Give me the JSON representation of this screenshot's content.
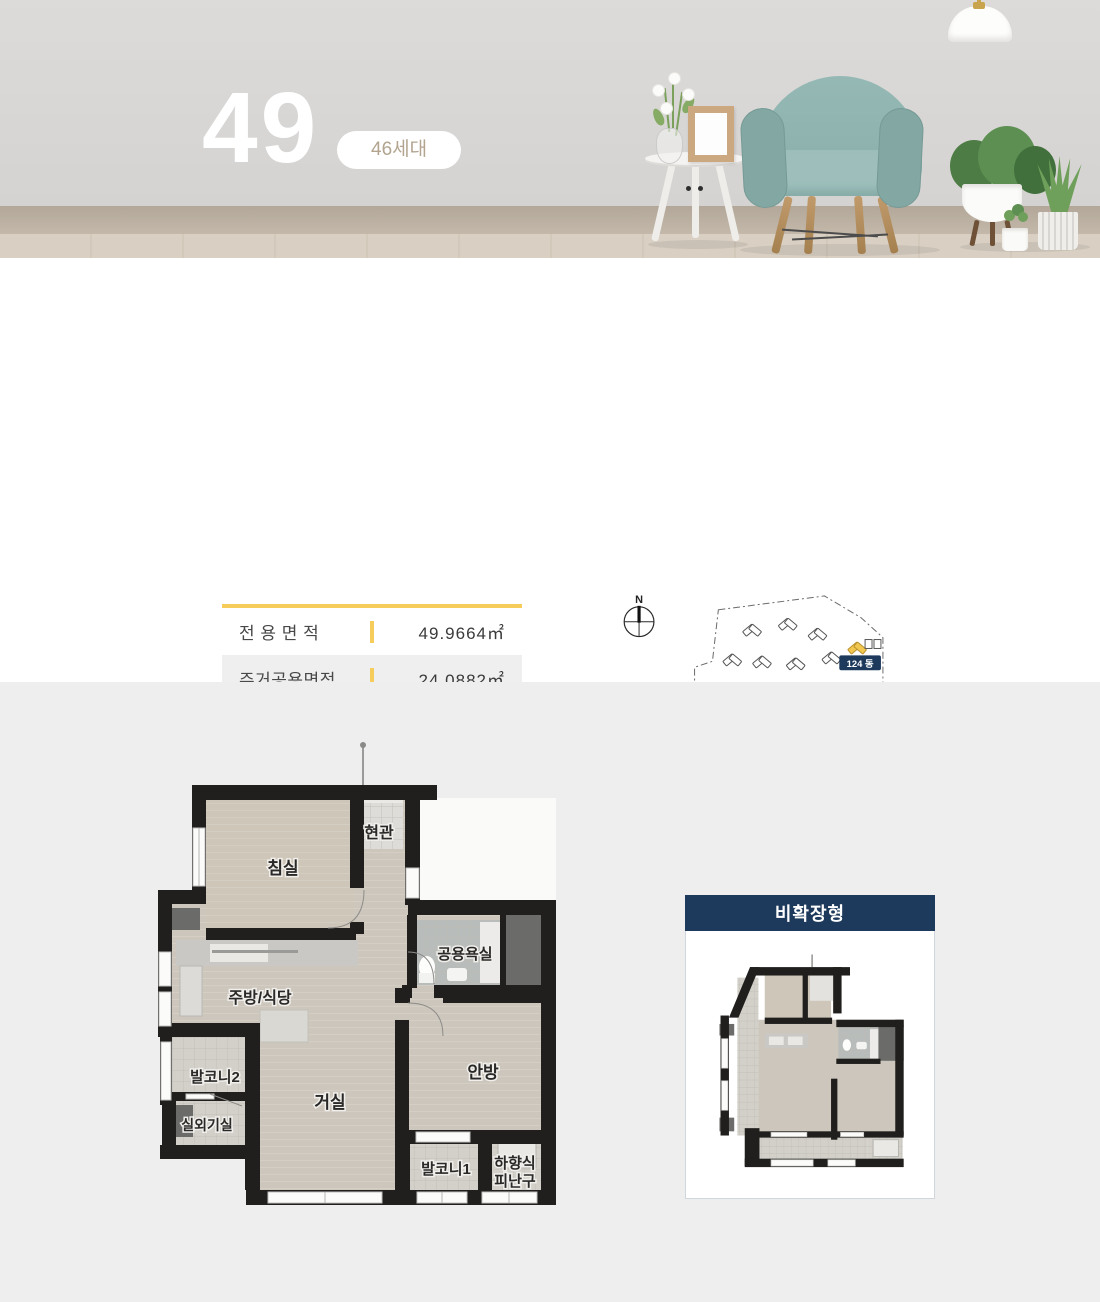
{
  "hero": {
    "unit_number": "49",
    "households_badge": "46세대"
  },
  "area_table": {
    "rows": [
      {
        "label": "전 용 면 적",
        "value": "49.9664㎡"
      },
      {
        "label": "주거공용면적",
        "value": "24.0882㎡"
      },
      {
        "label": "공 급 면 적",
        "value": "74.0546㎡"
      },
      {
        "label": "기타공용면적",
        "value": "42.7552㎡"
      },
      {
        "label": "계 약 면 적",
        "value": "116.8098㎡"
      }
    ]
  },
  "keymap": {
    "compass_label": "N",
    "building_badge": "124 동",
    "button_label": "KEY MAP"
  },
  "floorplan": {
    "rooms": {
      "entrance": "현관",
      "bedroom": "침실",
      "bathroom": "공용욕실",
      "kitchen": "주방/식당",
      "balcony2": "발코니2",
      "outdoor_unit": "실외기실",
      "living": "거실",
      "master": "안방",
      "balcony1": "발코니1",
      "hatch_line1": "하향식",
      "hatch_line2": "피난구"
    }
  },
  "mini_plan": {
    "title": "비확장형"
  },
  "colors": {
    "accent_yellow": "#F6CD5B",
    "button_yellow": "#F6CE6B",
    "navy": "#1D3A5C",
    "badge_text_tan": "#B2A48F",
    "wall_black": "#201F1D",
    "floor_beige": "#CDC6BC",
    "section_gray": "#EEEEEE"
  }
}
